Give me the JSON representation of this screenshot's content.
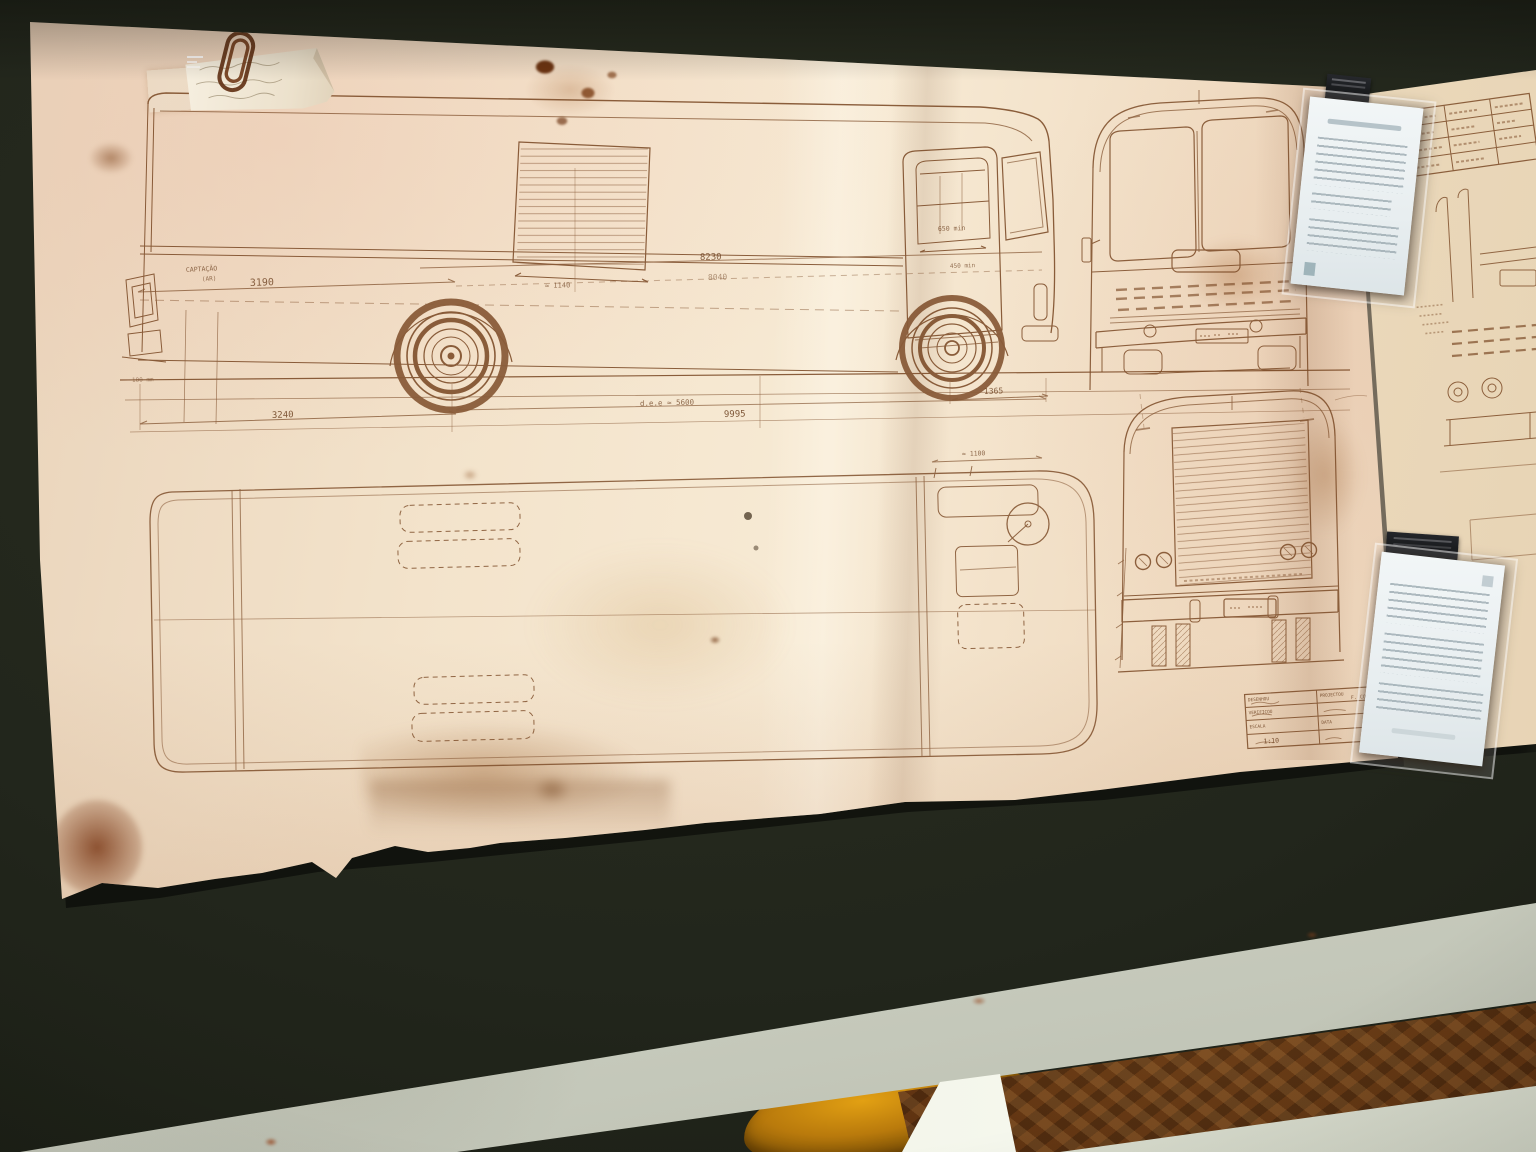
{
  "scene": {
    "description": "Aged bus engineering drawing (side, front, rear, plan views) photographed on a dark museum table with two interpretation cards",
    "colors": {
      "table": "#22261c",
      "paper": "#f0dfc6",
      "paper_second_sheet": "#e9d6b6",
      "ink": "#7b4a26",
      "card": "#eef3f4",
      "sticker": "#4e93a6",
      "parquet_floor": "#5d3110",
      "table_edge": "#d9dccf",
      "amber_object": "#b97a0c"
    }
  },
  "blueprint": {
    "dims": {
      "d3190": "3190",
      "d8230": "8230",
      "d8040": "8040",
      "d1140": "≈ 1140",
      "ddee": "d.e.e ≈ 5600",
      "d9995": "9995",
      "d3240": "3240",
      "d1365": "1365",
      "d1100": "≈ 1100",
      "d650": "650 min",
      "d450": "450 min",
      "d100": "100 mm"
    },
    "notes": {
      "air1": "CAPTAÇÃO",
      "air2": "(AR)"
    },
    "title_block": {
      "drew": "DESENHOU",
      "designed": "PROJECTOU",
      "checked": "VERIFICOU",
      "scale": "ESCALA",
      "date": "DATA",
      "scale_value": "1:10",
      "drafter": "F. COSTA"
    }
  }
}
